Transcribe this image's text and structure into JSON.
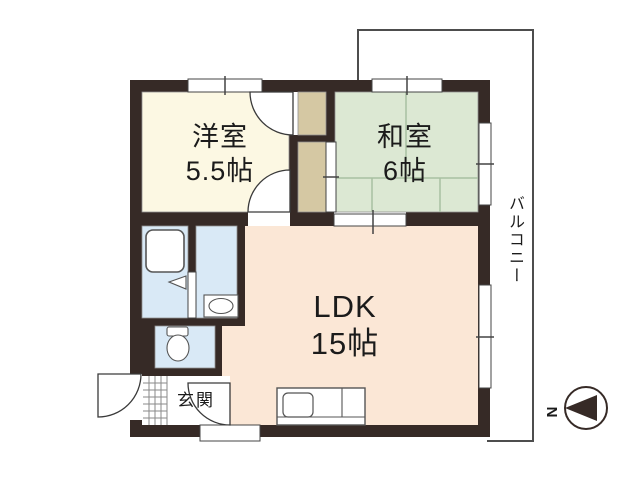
{
  "rooms": {
    "western": {
      "name": "洋室",
      "size": "5.5帖"
    },
    "japanese": {
      "name": "和室",
      "size": "6帖"
    },
    "ldk": {
      "name": "LDK",
      "size": "15帖"
    },
    "entrance": {
      "name": "玄関"
    },
    "balcony": {
      "name": "バルコニー"
    }
  },
  "compass": {
    "north_label": "N"
  },
  "colors": {
    "wall": "#362a26",
    "western_room_floor": "#fcf8e3",
    "japanese_room_floor": "#dce8d3",
    "ldk_floor": "#fbe7d6",
    "wet_area_floor": "#d9e9f6",
    "closet": "#d5c8a3",
    "tatami_line": "#a8bfa1",
    "balcony_line": "#4d4d4d",
    "fixture_line": "#555555"
  }
}
